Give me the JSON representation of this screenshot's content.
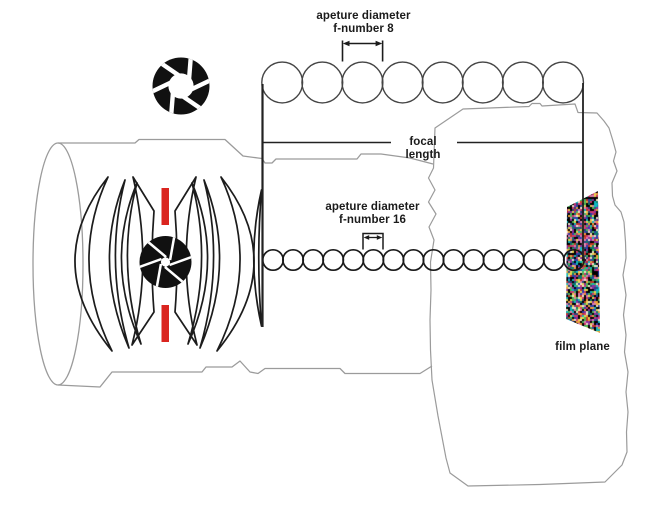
{
  "labels": {
    "aperture8": {
      "line1": "apeture diameter",
      "line2": "f-number 8"
    },
    "aperture16": {
      "line1": "apeture diameter",
      "line2": "f-number 16"
    },
    "focal_length": "focal length",
    "film_plane": "film plane"
  },
  "rows": {
    "f8_count": 8,
    "f16_count": 16
  },
  "colors": {
    "marker_red": "#da251f",
    "outline_gray": "#9b9b9b",
    "ink": "#1b1b1b"
  },
  "icons": {
    "top_left": "aperture-ring-icon",
    "lens_center": "aperture-blades-icon"
  }
}
